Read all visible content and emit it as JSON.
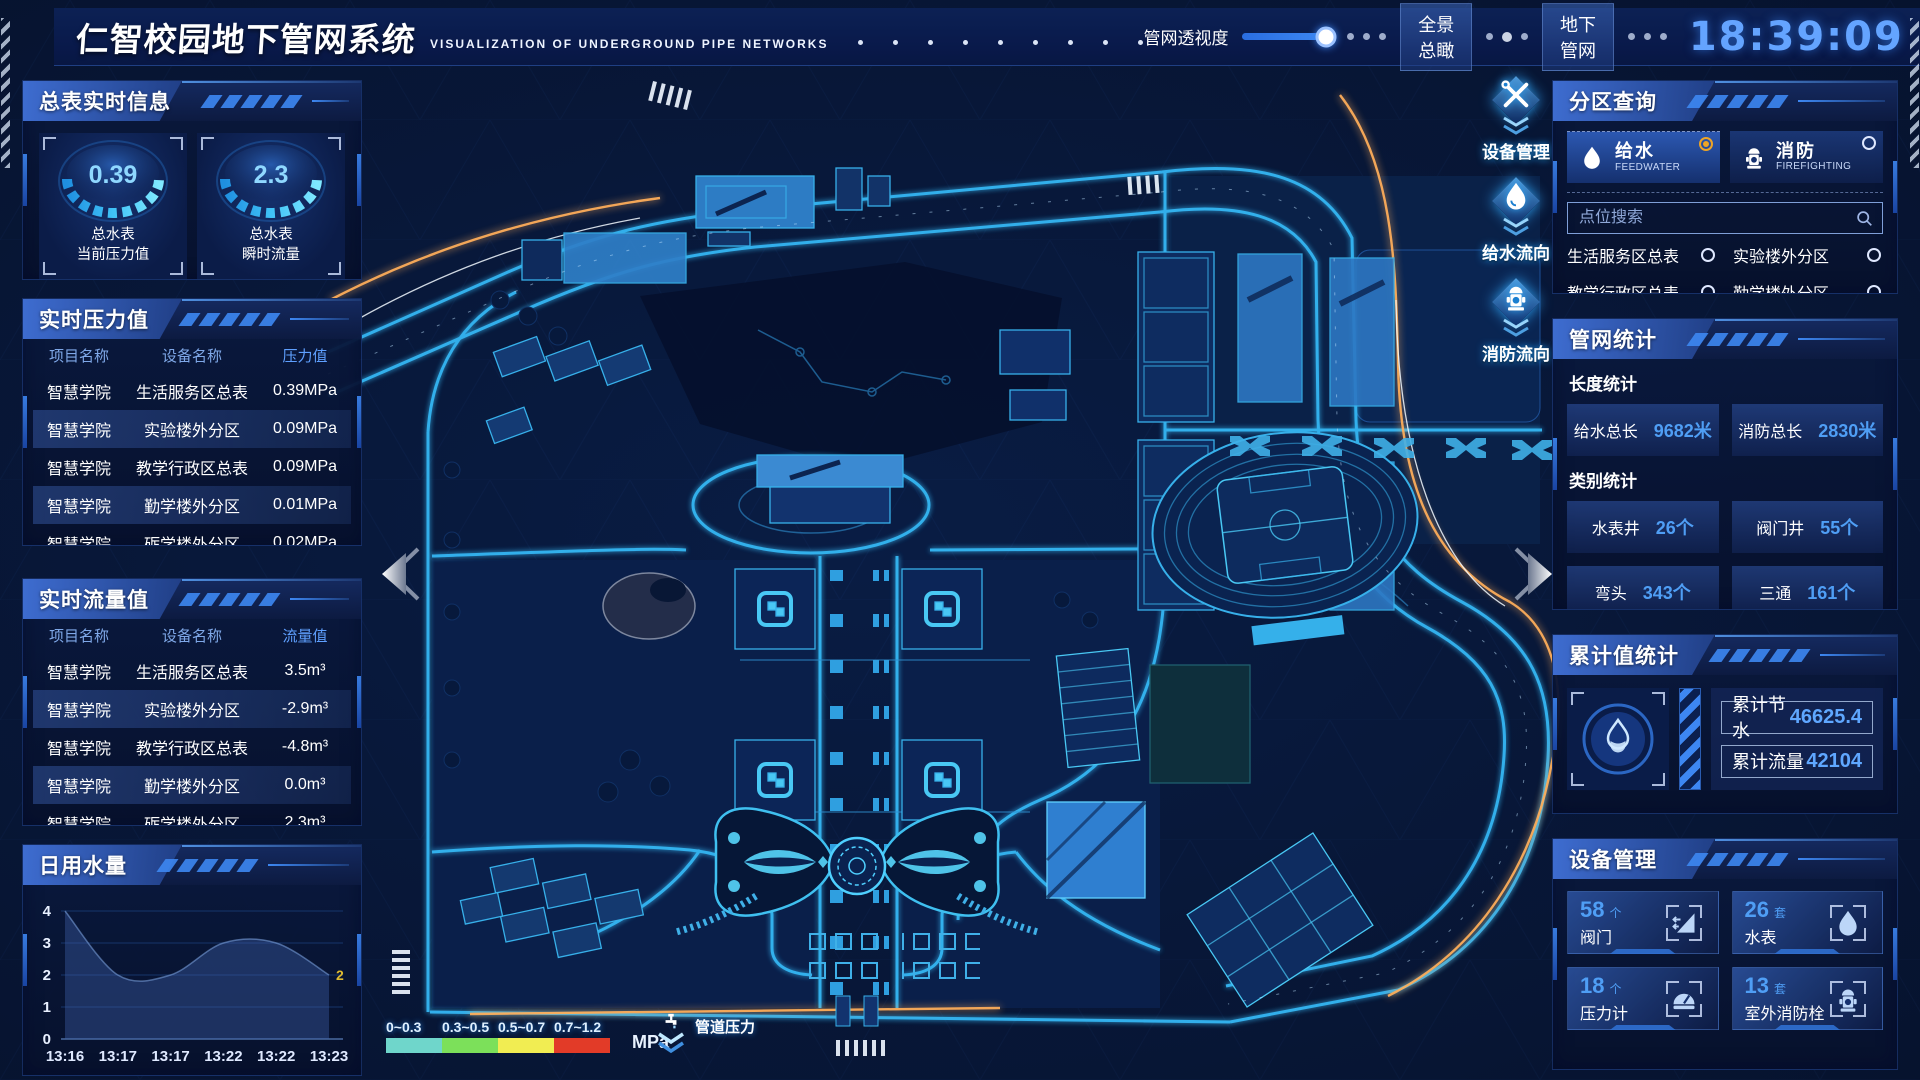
{
  "header": {
    "title": "仁智校园地下管网系统",
    "subtitle": "VISUALIZATION OF UNDERGROUND PIPE NETWORKS",
    "slider_label": "管网透视度",
    "slider_value": 92,
    "buttons": [
      {
        "label": "全景总瞰"
      },
      {
        "label": "地下管网"
      }
    ],
    "clock": "18:39:09",
    "weekday": "星期五",
    "date": "2023-03-24"
  },
  "meter_panel": {
    "title": "总表实时信息",
    "gauges": [
      {
        "value": "0.39",
        "line1": "总水表",
        "line2": "当前压力值"
      },
      {
        "value": "2.3",
        "line1": "总水表",
        "line2": "瞬时流量"
      }
    ]
  },
  "pressure_panel": {
    "title": "实时压力值",
    "col_project": "项目名称",
    "col_device": "设备名称",
    "col_value": "压力值",
    "rows": [
      {
        "project": "智慧学院",
        "device": "生活服务区总表",
        "value": "0.39MPa"
      },
      {
        "project": "智慧学院",
        "device": "实验楼外分区",
        "value": "0.09MPa"
      },
      {
        "project": "智慧学院",
        "device": "教学行政区总表",
        "value": "0.09MPa"
      },
      {
        "project": "智慧学院",
        "device": "勤学楼外分区",
        "value": "0.01MPa"
      },
      {
        "project": "智慧学院",
        "device": "砺学楼外分区",
        "value": "0.02MPa"
      }
    ]
  },
  "flow_panel": {
    "title": "实时流量值",
    "col_project": "项目名称",
    "col_device": "设备名称",
    "col_value": "流量值",
    "rows": [
      {
        "project": "智慧学院",
        "device": "生活服务区总表",
        "value": "3.5m³"
      },
      {
        "project": "智慧学院",
        "device": "实验楼外分区",
        "value": "-2.9m³"
      },
      {
        "project": "智慧学院",
        "device": "教学行政区总表",
        "value": "-4.8m³"
      },
      {
        "project": "智慧学院",
        "device": "勤学楼外分区",
        "value": "0.0m³"
      },
      {
        "project": "智慧学院",
        "device": "砺学楼外分区",
        "value": "2.3m³"
      }
    ]
  },
  "chart_data": {
    "type": "area",
    "title": "日用水量",
    "x": [
      "13:16",
      "13:17",
      "13:17",
      "13:22",
      "13:22",
      "13:23"
    ],
    "values": [
      4,
      2,
      2,
      3,
      3,
      2
    ],
    "ylim": [
      0,
      4
    ],
    "yticks": [
      4,
      3,
      2,
      1,
      0
    ],
    "grid": true,
    "legend_position": "none",
    "end_label": "2"
  },
  "zone_panel": {
    "title": "分区查询",
    "tabs": [
      {
        "label": "给水",
        "sub": "FEEDWATER",
        "selected": true
      },
      {
        "label": "消防",
        "sub": "FIREFIGHTING",
        "selected": false
      }
    ],
    "search_placeholder": "点位搜索",
    "items": [
      "生活服务区总表",
      "实验楼外分区",
      "教学行政区总表",
      "勤学楼外分区",
      "砺学楼外分区",
      "宿舍区泵房"
    ]
  },
  "stats_panel": {
    "title": "管网统计",
    "length_title": "长度统计",
    "length_items": [
      {
        "label": "给水总长",
        "value": "9682米"
      },
      {
        "label": "消防总长",
        "value": "2830米"
      }
    ],
    "category_title": "类别统计",
    "category_items": [
      {
        "label": "水表井",
        "value": "26个"
      },
      {
        "label": "阀门井",
        "value": "55个"
      },
      {
        "label": "弯头",
        "value": "343个"
      },
      {
        "label": "三通",
        "value": "161个"
      }
    ]
  },
  "total_panel": {
    "title": "累计值统计",
    "items": [
      {
        "label": "累计节水",
        "value": "46625.4"
      },
      {
        "label": "累计流量",
        "value": "42104"
      }
    ]
  },
  "device_panel": {
    "title": "设备管理",
    "cards": [
      {
        "count": "58",
        "unit": "个",
        "label": "阀门"
      },
      {
        "count": "26",
        "unit": "套",
        "label": "水表"
      },
      {
        "count": "18",
        "unit": "个",
        "label": "压力计"
      },
      {
        "count": "13",
        "unit": "套",
        "label": "室外消防栓"
      }
    ]
  },
  "map": {
    "tools": [
      {
        "label": "设备管理"
      },
      {
        "label": "给水流向"
      },
      {
        "label": "消防流向"
      }
    ],
    "legend": {
      "ranges": [
        "0~0.3",
        "0.3~0.5",
        "0.5~0.7",
        "0.7~1.2"
      ],
      "colors": [
        "#6fd6cb",
        "#7ce05a",
        "#f1ed52",
        "#e23b28"
      ],
      "unit": "MPa",
      "pointer_label": "管道压力"
    }
  }
}
